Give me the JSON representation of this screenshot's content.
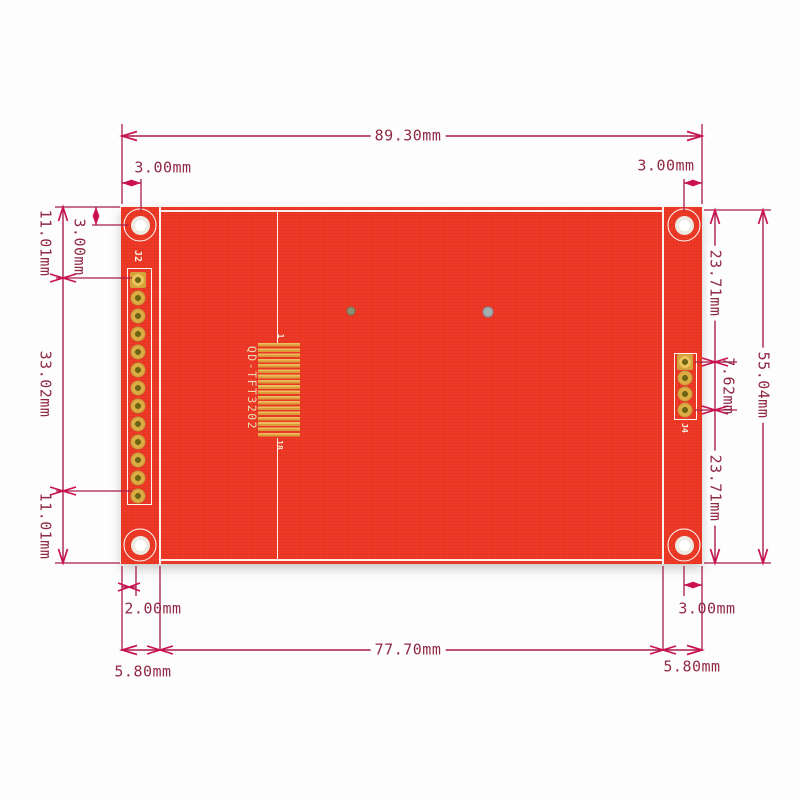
{
  "pcb": {
    "model_silkscreen": "QD-TFT3202",
    "left_header_label": "J2",
    "right_header_label": "J4",
    "fpc_pin_first": "1",
    "fpc_pin_last": "18"
  },
  "dimensions": {
    "board_width": "89.30mm",
    "hole_offset_top_left": "3.00mm",
    "hole_offset_top_right": "3.00mm",
    "hole_offset_left_vertical": "3.00mm",
    "left_top_segment": "11.01mm",
    "left_header_span": "33.02mm",
    "left_bottom_segment": "11.01mm",
    "right_top_segment": "23.71mm",
    "right_header_span": "7.62mm",
    "right_bottom_segment": "23.71mm",
    "board_height": "55.04mm",
    "bottom_left_hole_offset": "2.00mm",
    "bottom_right_hole_offset": "3.00mm",
    "bottom_left_strip": "5.80mm",
    "bottom_center_span": "77.70mm",
    "bottom_right_strip": "5.80mm"
  },
  "colors": {
    "board_red": "#ee3a26",
    "dimension_line": "#a81c4b",
    "arrow_accent": "#cb1150",
    "pad_gold": "#dcab41",
    "silkscreen_white": "#f7f1e2"
  }
}
